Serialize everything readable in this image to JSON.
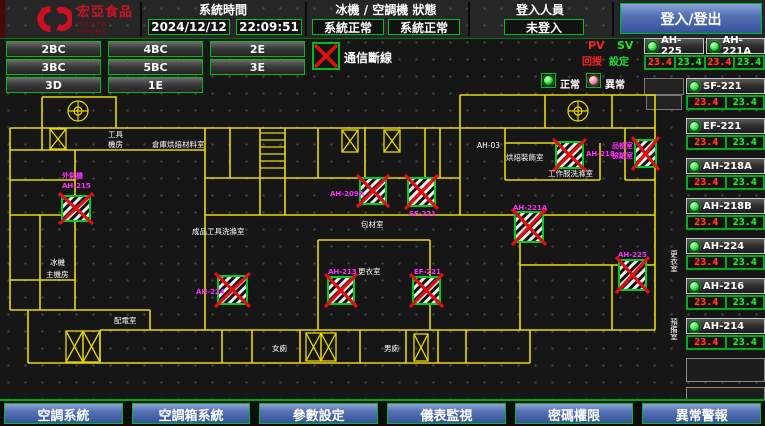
{
  "header": {
    "logo": {
      "brand": "宏亞食品",
      "brand_sub": "HUNYA FOODS"
    },
    "system_time": {
      "label": "系統時間",
      "date": "2024/12/12",
      "time": "22:09:51"
    },
    "machine_status": {
      "label": "冰機 / 空調機 狀態",
      "chiller_status": "系統正常",
      "ahu_status": "系統正常"
    },
    "login": {
      "label": "登入人員",
      "user": "未登入",
      "button": "登入/登出"
    }
  },
  "floor_buttons": [
    "2BC",
    "4BC",
    "2E",
    "3BC",
    "5BC",
    "3E",
    "3D",
    "1E"
  ],
  "legend": {
    "comm_loss": "通信斷線",
    "pv": "PV",
    "sv": "SV",
    "pv_label": "回授",
    "sv_label": "設定",
    "normal": "正常",
    "abnormal": "異常"
  },
  "units": [
    {
      "name": "AH-225",
      "pv": "23.4",
      "sv": "23.4"
    },
    {
      "name": "AH-221A",
      "pv": "23.4",
      "sv": "23.4"
    },
    {
      "name": "SF-221",
      "pv": "23.4",
      "sv": "23.4"
    },
    {
      "name": "EF-221",
      "pv": "23.4",
      "sv": "23.4"
    },
    {
      "name": "AH-218A",
      "pv": "23.4",
      "sv": "23.4"
    },
    {
      "name": "AH-218B",
      "pv": "23.4",
      "sv": "23.4"
    },
    {
      "name": "AH-224",
      "pv": "23.4",
      "sv": "23.4"
    },
    {
      "name": "AH-216",
      "pv": "23.4",
      "sv": "23.4"
    },
    {
      "name": "AH-214",
      "pv": "23.4",
      "sv": "23.4"
    }
  ],
  "floorplan": {
    "labels": {
      "d1a": "外氣機",
      "d1b": "AH-215",
      "d2": "AH-209A",
      "d3": "SF-221",
      "d4": "AH-221A",
      "d5": "AH-218",
      "d6a": "品檢室",
      "d6b": "檢驗室",
      "d7": "AH-213",
      "d8": "EF-221",
      "d9": "AH-224",
      "d10": "AH-225",
      "r1a": "工具",
      "r1b": "機房",
      "r2": "倉庫烘焙材料室",
      "r3": "AH-03",
      "r4": "烘焙裝飾室",
      "r5": "工作服洗滌室",
      "r6": "成品工具洗滌室",
      "r7": "包材室",
      "r8": "更衣室",
      "r9a": "冰機",
      "r9b": "主機房",
      "r10": "配電室",
      "r11": "女廁",
      "r12": "男廁",
      "r13": "更衣室",
      "r14": "預備室"
    }
  },
  "bottom_buttons": [
    "空調系統",
    "空調箱系統",
    "參數設定",
    "儀表監視",
    "密碼權限",
    "異常警報"
  ],
  "colors": {
    "accent_green": "#00bb22",
    "alarm_red": "#e01010",
    "device_magenta": "#ff2bff",
    "wall_yellow": "#e8d900",
    "button_blue": "#5571b4"
  }
}
